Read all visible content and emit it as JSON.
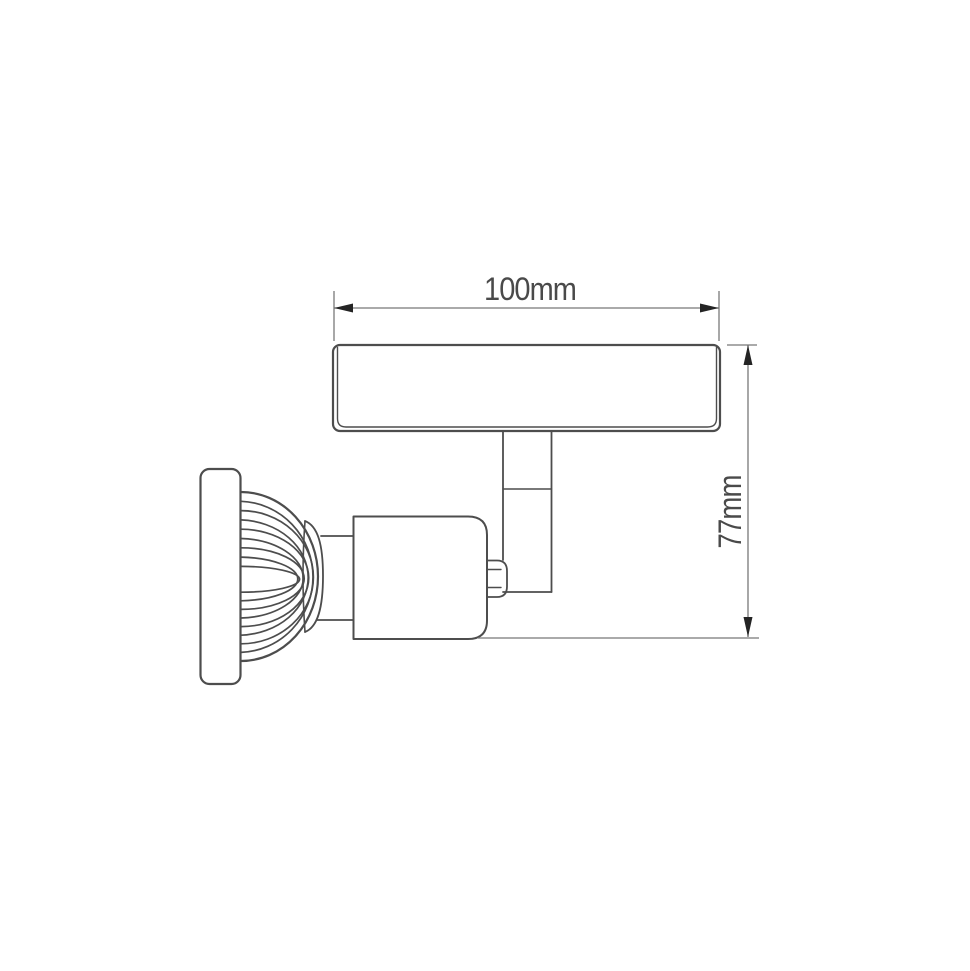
{
  "page": {
    "title": "Spotlight fixture technical drawing",
    "background": "#ffffff"
  },
  "drawing": {
    "view": "side-view line drawing of a wall-mounted single spotlight",
    "parts": [
      "mounting-plate",
      "stem",
      "swivel-knuckle",
      "lamp-holder",
      "heatsink-fins",
      "lamp-bezel"
    ]
  },
  "dimensions": {
    "width": {
      "label": "100mm",
      "value": 100,
      "unit": "mm"
    },
    "height": {
      "label": "77mm",
      "value": 77,
      "unit": "mm"
    }
  },
  "colors": {
    "line": "#4d4d4d",
    "dim_line": "#787878",
    "arrow": "#242424",
    "text": "#4a4a4a",
    "background": "#ffffff"
  }
}
